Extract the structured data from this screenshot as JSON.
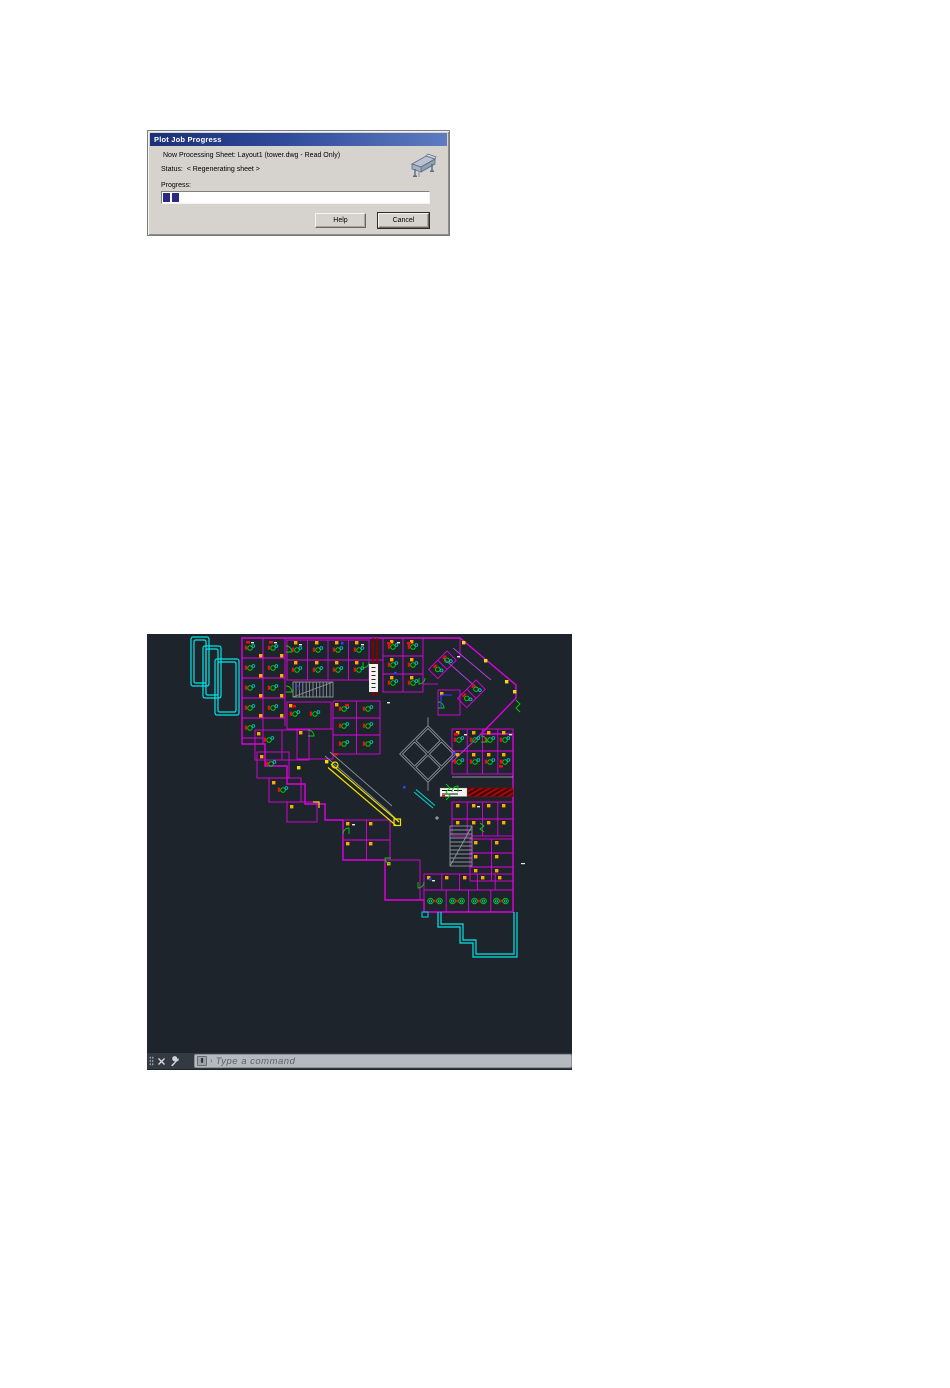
{
  "dialog": {
    "title": "Plot Job Progress",
    "processing_text": "Now Processing Sheet: Layout1 (tower.dwg - Read Only)",
    "status_label": "Status:",
    "status_value": "< Regenerating sheet >",
    "progress_label": "Progress:",
    "progress": {
      "segments_filled": 2,
      "segments_total": 33,
      "percent_estimate": 6
    },
    "buttons": {
      "help": "Help",
      "cancel": "Cancel"
    },
    "icon": "plotter-icon",
    "colors": {
      "face": "#d6d3ce",
      "titlebar_left": "#1c3076",
      "titlebar_right": "#5e7cc0",
      "progress_segment": "#2a2a84"
    }
  },
  "cad": {
    "command_line": {
      "placeholder": "Type a command",
      "close_icon": "close-icon",
      "customize_icon": "wrench-icon",
      "prompt_icon": "keyboard-icon"
    },
    "drawing": {
      "description": "Floor plan of L-shaped office tower level with angled wing",
      "colors": {
        "background": "#1e242c",
        "walls": "#e000e0",
        "terrace_glass": "#00e5e5",
        "corridor": "#f0e000",
        "furniture": "#00d400",
        "accents": "#e81010",
        "door_markers": "#ffaa00",
        "core_gray": "#8d939b",
        "label_bar_red": "#8a0000",
        "marks_blue": "#2945ff"
      }
    }
  }
}
